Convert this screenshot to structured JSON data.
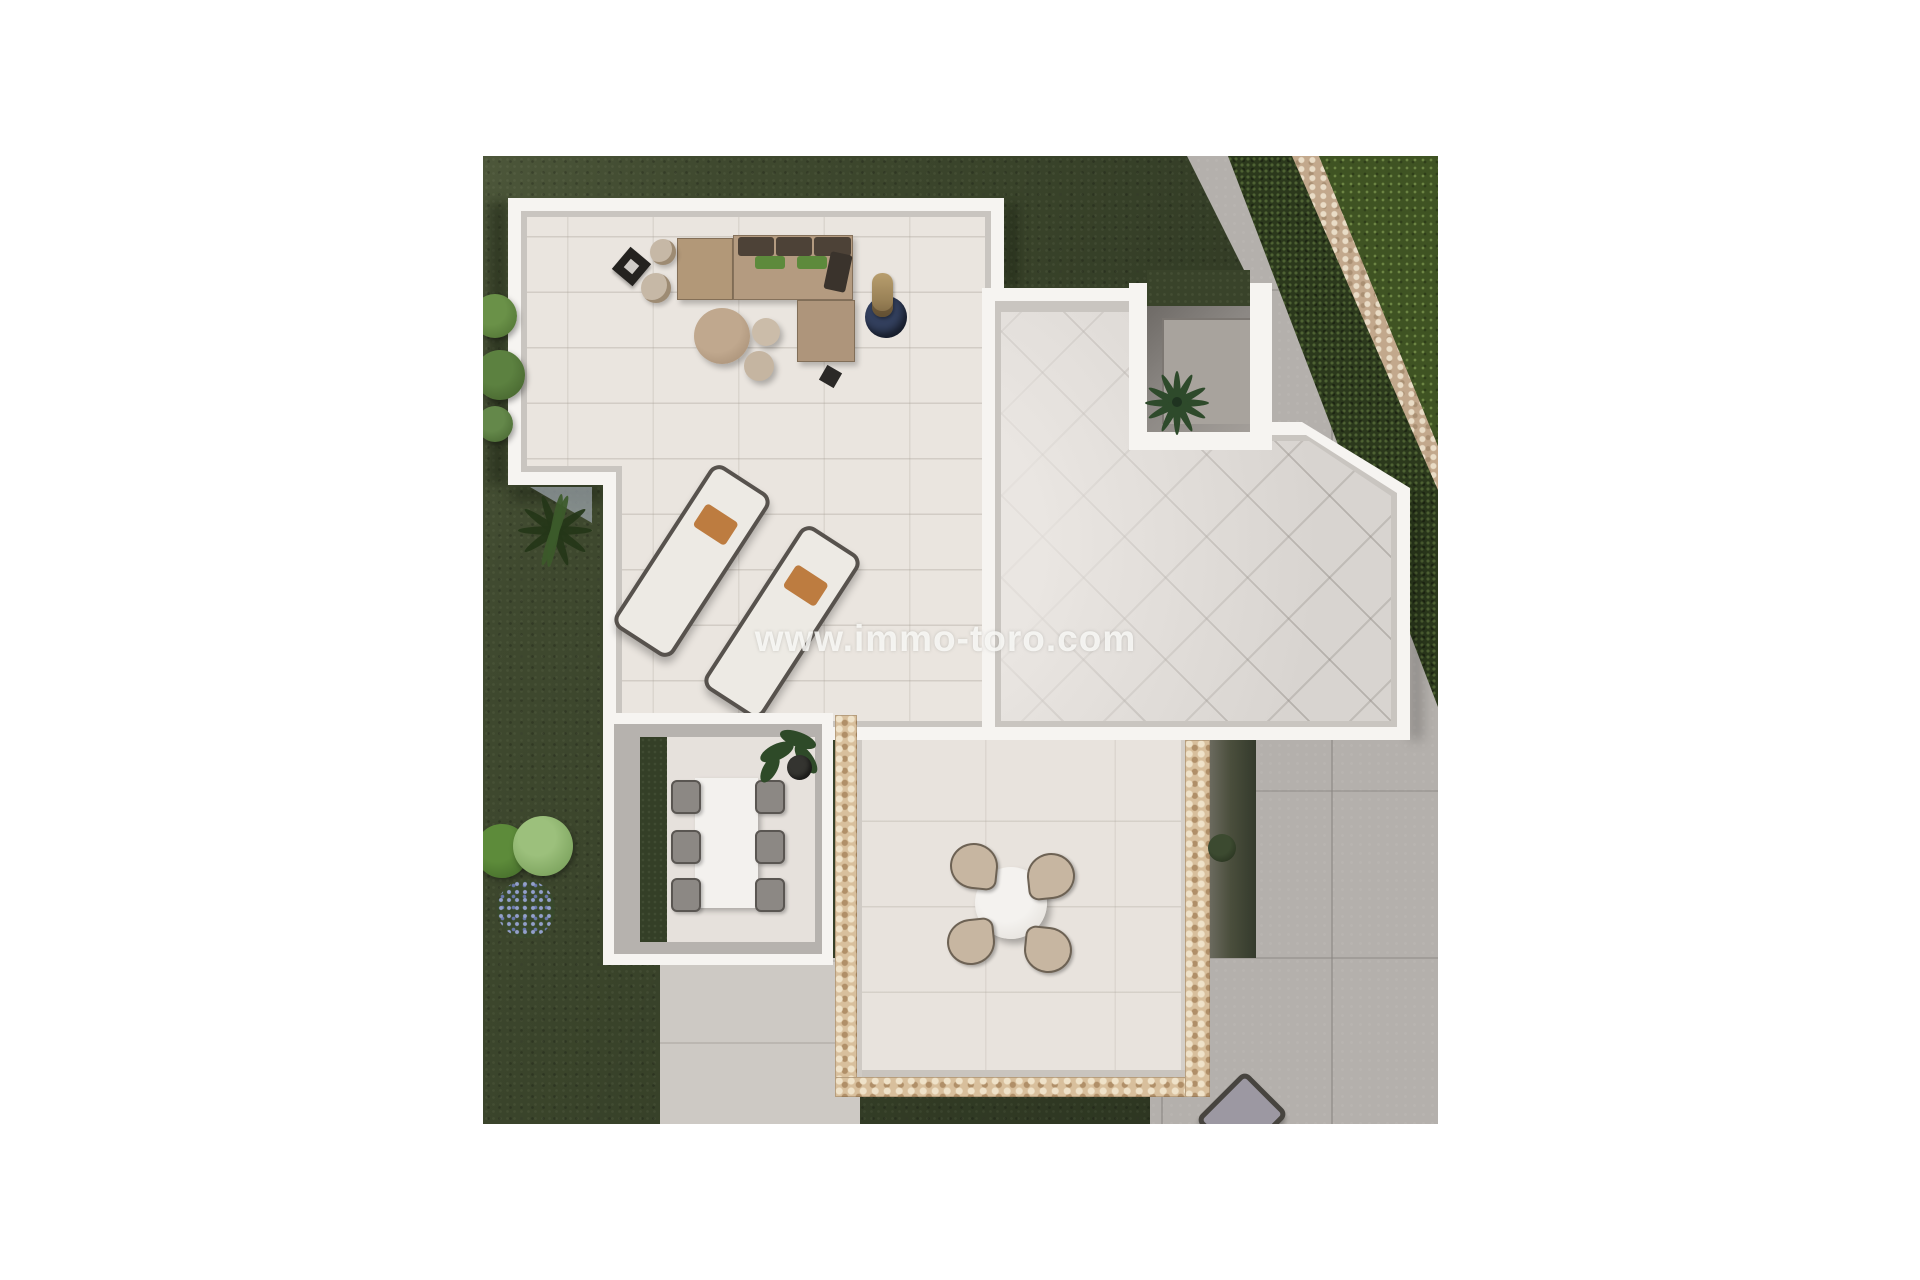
{
  "page": {
    "background": "#ffffff",
    "description": "Top-down 3D architectural render of a modern villa: flat roof terrace with lounge set and sun loungers, marble roof wing with sunken palm courtyard, dining patio with table for six, lower patio with round table for four, lawns, hedge and stone boundary wall",
    "width_px": 1920,
    "height_px": 1280
  },
  "watermark": {
    "text": "www.immo-toro.com",
    "color": "#ffffff",
    "opacity": 0.82
  },
  "scene": {
    "garden": {
      "lawn_color": "#39432a",
      "neighbor_lawn_color": "#3f5323",
      "hedge_color": "#2b381c",
      "stone_wall_color": "#c2a88c",
      "bushes": [
        "green bush cluster upper left",
        "light green bushes with blue flower cluster lower left",
        "agave silhouette beside terrace notch"
      ]
    },
    "roof_terrace": {
      "floor_color": "#eae5df",
      "border_color": "#f6f4f1",
      "furniture": [
        "L-shaped corner sofa with dark brown back cushions and two green pillows",
        "large round ottoman",
        "two small poufs",
        "two cylinder side tables",
        "black tray table",
        "column plant on round navy rug",
        "small black stool",
        "two sun loungers with orange pillows"
      ]
    },
    "marble_roof_wing": {
      "floor_color": "#d8d4d0",
      "courtyard": {
        "wall_color": "#8b8783",
        "floor_color": "#a8a39d",
        "plant": "palm seen from above"
      }
    },
    "dining_patio": {
      "table": "white rectangular dining table",
      "chair_count": 6,
      "chair_color": "#8c8884",
      "plant": "potted green plant",
      "grass_strip": true
    },
    "lower_patio": {
      "border": "pebble mosaic strips",
      "mosaic_color": "#d8bf9c",
      "table": "round white table",
      "chair_count": 4,
      "chair_color": "#c7b6a1"
    },
    "ground": {
      "concrete_color": "#b4b0ac",
      "light_paving_color": "#cdc9c4",
      "objects": [
        "dark planting strip with shrub",
        "sun lounger cut by bottom edge"
      ]
    }
  }
}
